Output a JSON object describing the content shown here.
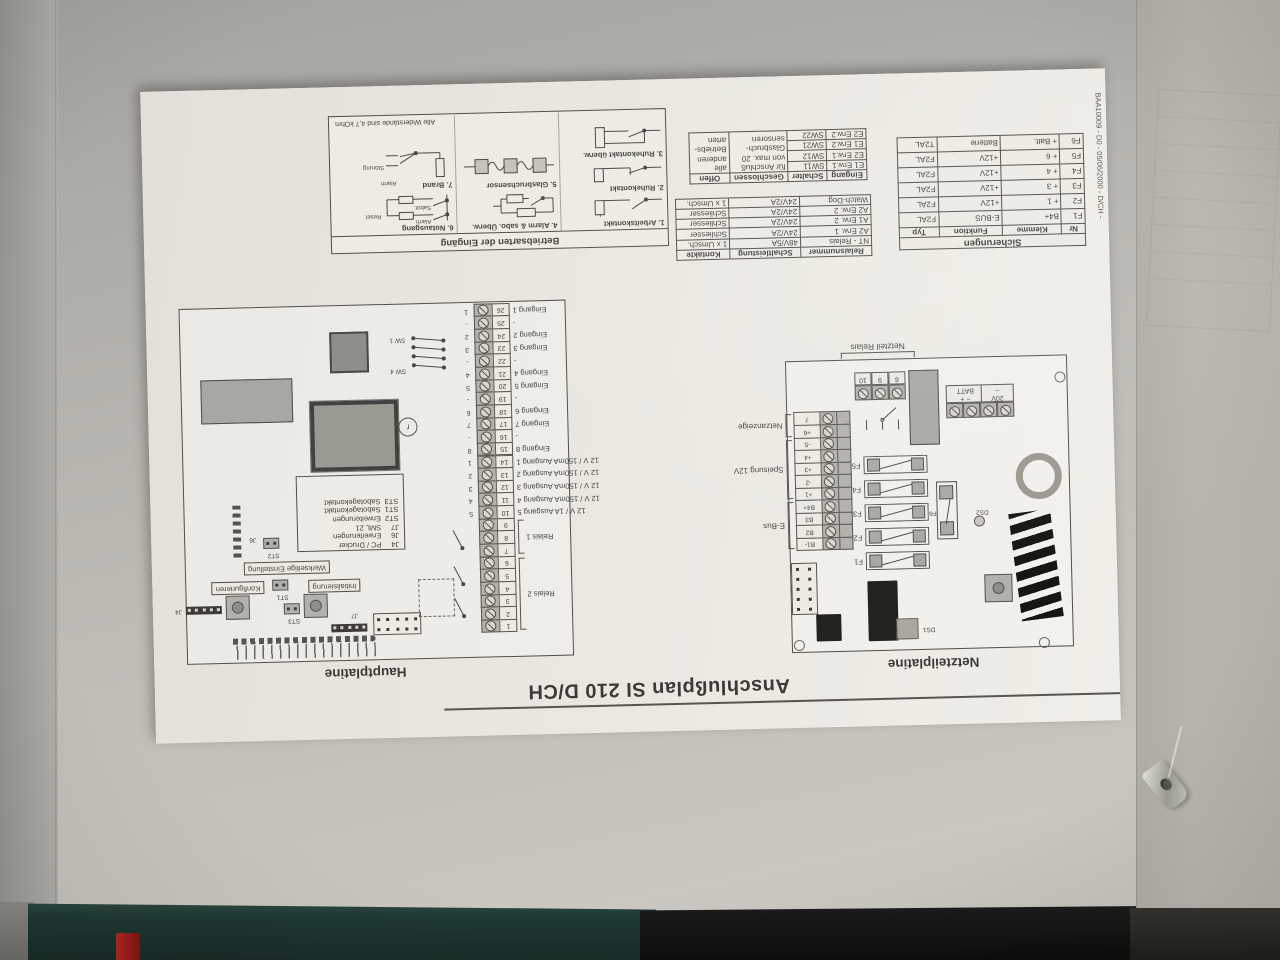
{
  "photo": {
    "wall_color": "#b6b4ae",
    "paper_color": "#e9e7e0",
    "ink_color": "#454440",
    "machine_teal": "#1f3833",
    "machine_black": "#0c0c0b",
    "accent_red": "#b3261e"
  },
  "document": {
    "title": "Anschlußplan SI 210 D/CH",
    "doc_code": "BAA10009 - D0 - 05/06/2000 - D/CH -",
    "netzteil": {
      "caption": "Netzteilplatine",
      "relais_caption": "Netzteil Relais",
      "relais_terminals": [
        "8",
        "9",
        "10"
      ],
      "batt": {
        "left": "20V",
        "tilde": "~",
        "minus": "−",
        "plus": "+",
        "label": "BATT"
      },
      "fuses": [
        "F1",
        "F2",
        "F3",
        "F4",
        "F5"
      ],
      "fuse6": "F6",
      "groups": [
        {
          "label": "E-Bus",
          "terminals": [
            "B1-",
            "B2",
            "B3",
            "B4+"
          ]
        },
        {
          "label": "Speisung 12V",
          "terminals": [
            "+1",
            "-2",
            "+3",
            "+4",
            "-5"
          ]
        },
        {
          "label": "Netzanzeige",
          "terminals": [
            "+6",
            "7"
          ]
        }
      ],
      "ds1": "DS1",
      "ds2": "DS2"
    },
    "haupt": {
      "caption": "Hauptplatine",
      "relais_groups": [
        {
          "label": "Relais 2"
        },
        {
          "label": "Relais 1"
        }
      ],
      "terminals": [
        {
          "n": "1"
        },
        {
          "n": "2"
        },
        {
          "n": "3"
        },
        {
          "n": "4"
        },
        {
          "n": "5"
        },
        {
          "n": "6"
        },
        {
          "n": "7"
        },
        {
          "n": "8"
        },
        {
          "n": "9"
        },
        {
          "n": "10",
          "o": "5",
          "l": "12 V / 1A Ausgang 5"
        },
        {
          "n": "11",
          "o": "4",
          "l": "12 V / 150mA Ausgang 4"
        },
        {
          "n": "12",
          "o": "3",
          "l": "12 V / 150mA Ausgang 3"
        },
        {
          "n": "13",
          "o": "2",
          "l": "12 V / 150mA Ausgang 2"
        },
        {
          "n": "14",
          "o": "1",
          "l": "12 V / 150mA Ausgang 1"
        },
        {
          "n": "15",
          "o": "8",
          "l": "Eingang 8"
        },
        {
          "n": "16",
          "o": "-",
          "l": "-"
        },
        {
          "n": "17",
          "o": "7",
          "l": "Eingang 7"
        },
        {
          "n": "18",
          "o": "6",
          "l": "Eingang 6"
        },
        {
          "n": "19",
          "o": "-",
          "l": "-"
        },
        {
          "n": "20",
          "o": "5",
          "l": "Eingang 5"
        },
        {
          "n": "21",
          "o": "4",
          "l": "Eingang 4"
        },
        {
          "n": "22",
          "o": "-",
          "l": "-"
        },
        {
          "n": "23",
          "o": "3",
          "l": "Eingang 3"
        },
        {
          "n": "24",
          "o": "2",
          "l": "Eingang 2"
        },
        {
          "n": "25",
          "o": "-",
          "l": "-"
        },
        {
          "n": "26",
          "o": "1",
          "l": "Eingang 1"
        }
      ],
      "legend": [
        {
          "k": "J4",
          "v": "PC / Drucker"
        },
        {
          "k": "J6",
          "v": "Erweiterungen"
        },
        {
          "k": "J7",
          "v": "SML 21"
        },
        {
          "k": "ST2",
          "v": "Erweiterungen"
        },
        {
          "k": "ST1",
          "v": "Sabotagekontakt"
        },
        {
          "k": "ST3",
          "v": "Sabotagekontakt"
        }
      ],
      "boxed": {
        "werk": "Werkseitige Einstellung",
        "init": "Initialisierung",
        "konf": "Konfigurieren"
      },
      "jumpers": {
        "st1": "ST1",
        "st2": "ST2",
        "st3": "ST3",
        "j4": "J4",
        "j6": "J6",
        "j7": "J7"
      },
      "sw_top": "SW 4",
      "sw_bottom": "SW 1"
    },
    "sicherungen": {
      "title": "Sicherungen",
      "headers": [
        "Nr",
        "Klemme",
        "Funktion",
        "Typ"
      ],
      "rows": [
        [
          "F1",
          "B4+",
          "E-BUS",
          "F2AL"
        ],
        [
          "F2",
          "+ 1",
          "+12V",
          "F2AL"
        ],
        [
          "F3",
          "+ 3",
          "+12V",
          "F2AL"
        ],
        [
          "F4",
          "+ 4",
          "+12V",
          "F2AL"
        ],
        [
          "F5",
          "+ 6",
          "+12V",
          "F2AL"
        ],
        [
          "F6",
          "+ Batt.",
          "Batterie",
          "T2AL"
        ]
      ]
    },
    "relais_table": {
      "headers": [
        "Relaisnummer",
        "Schaltleistung",
        "Kontakte"
      ],
      "rows": [
        [
          "NT - Relais",
          "48V/5A",
          "1 x Umsch."
        ],
        [
          "A2 Erw. 1",
          "24V/2A",
          "Schliesser"
        ],
        [
          "A1 Erw. 2",
          "24V/2A",
          "Schliesser"
        ],
        [
          "A2 Erw. 2",
          "24V/2A",
          "Schliesser"
        ],
        [
          "Watch-Dog",
          "24V/2A",
          "1 x Umsch."
        ]
      ]
    },
    "eingang_table": {
      "headers": [
        "Eingang",
        "Schalter",
        "Geschlossen",
        "Offen"
      ],
      "rows": [
        [
          "E1 Erw.1",
          "SW11"
        ],
        [
          "E2 Erw.1",
          "SW12"
        ],
        [
          "E1 Erw.2",
          "SW21"
        ],
        [
          "E2 Erw.2",
          "SW22"
        ]
      ],
      "geschlossen_lines": [
        "für Anschluß",
        "von max. 20",
        "Glasbruch-",
        "sensoren"
      ],
      "offen_lines": [
        "alle",
        "anderen",
        "Betriebs-",
        "arten"
      ]
    },
    "betriebsarten": {
      "title": "Betriebsarten der Eingäng",
      "items": [
        {
          "label": "1. Arbeitskontakt"
        },
        {
          "label": "2. Ruhekontakt"
        },
        {
          "label": "3. Ruhekontakt überw."
        },
        {
          "label": "4. Alarm & sabo. Überw."
        },
        {
          "label": "5. Glasbruchsensor"
        },
        {
          "label": "6. Notausgang",
          "sub": [
            "Alarm",
            "Sabot.",
            "Reset"
          ]
        },
        {
          "label": "7. Brand",
          "sub": [
            "Alarm",
            "Störung"
          ]
        }
      ],
      "footnote": "Alle Widerstände sind 4,7 kOhm"
    }
  }
}
